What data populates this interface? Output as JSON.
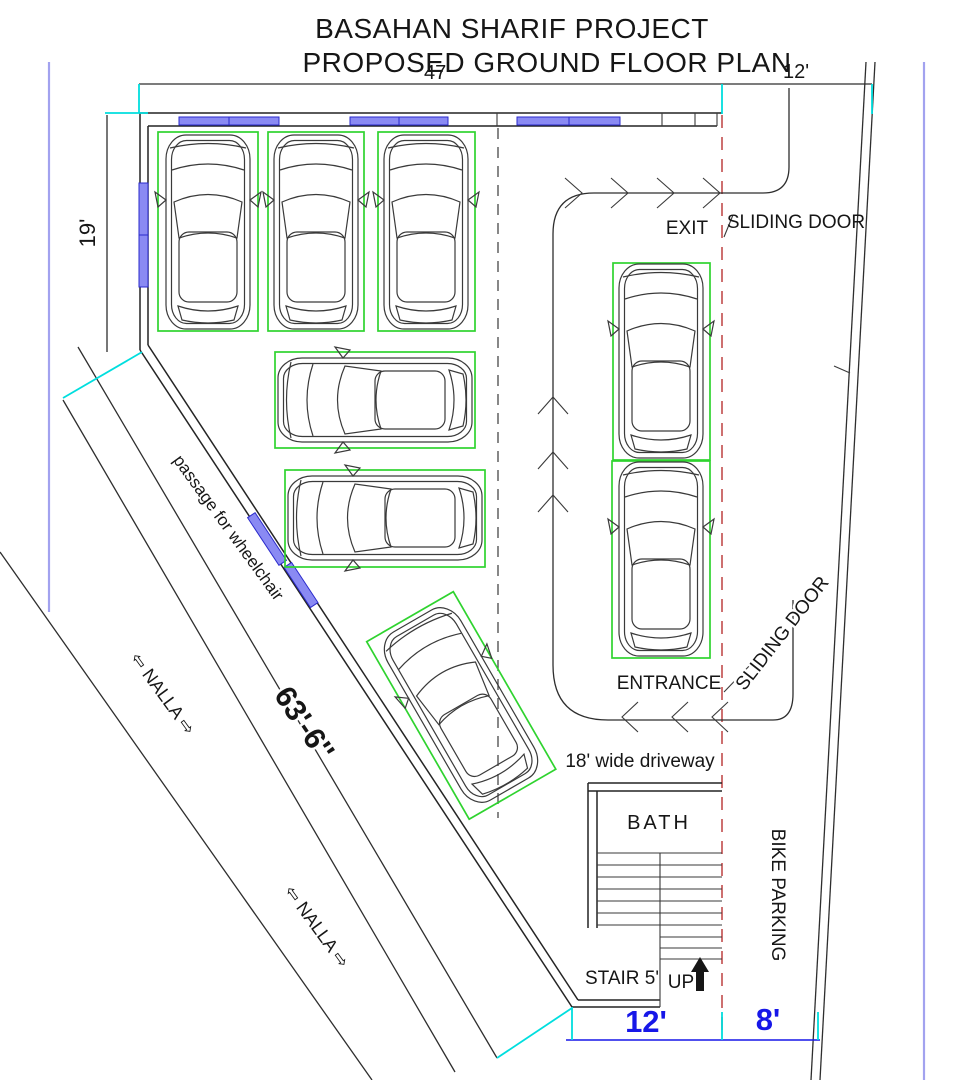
{
  "title": {
    "line1": "BASAHAN SHARIF PROJECT",
    "line2": "PROPOSED GROUND FLOOR PLAN"
  },
  "dimensions": {
    "top_width": "47'",
    "top_gate_width": "12'",
    "left_wall_height": "19'",
    "angled_boundary_length": "63'-6''",
    "bottom_gate_width": "12'",
    "bottom_right_width": "8'",
    "driveway_width_note": "18' wide driveway",
    "stair_width_note": "STAIR 5'"
  },
  "labels": {
    "exit": "EXIT",
    "entrance": "ENTRANCE",
    "sliding_door_exit": "SLIDING DOOR",
    "sliding_door_entrance": "SLIDING DOOR",
    "bath": "BATH",
    "bike_parking": "BIKE PARKING",
    "up": "UP",
    "nalla_upper": "⇦ NALLA ⇨",
    "nalla_lower": "⇦ NALLA ⇨",
    "passage": "passage for wheelchair"
  },
  "plan": {
    "car_count": 8,
    "colors": {
      "stall_green": "#2fd32f",
      "window_blue": "#8a8af3",
      "dimension_blue": "#1717e8",
      "tick_cyan": "#00dede",
      "sliding_door_red": "#c86060",
      "boundary_lavender": "#a2a2ef",
      "line_black": "#2e2e2e"
    }
  }
}
